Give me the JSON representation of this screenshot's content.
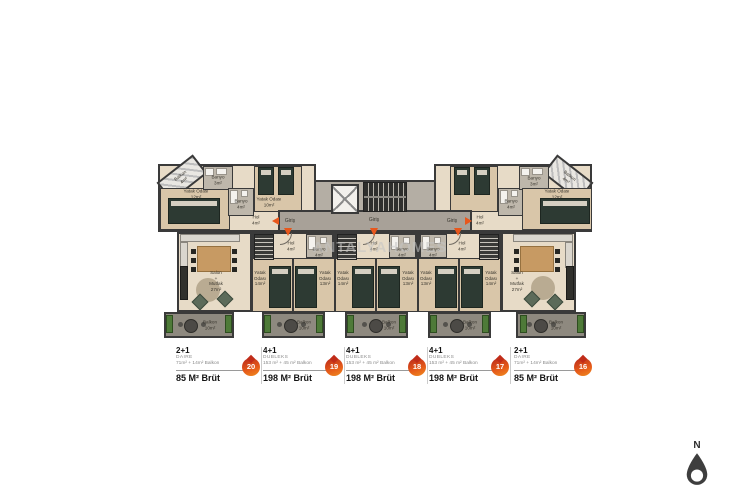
{
  "units": [
    {
      "type": "2+1",
      "subtype": "DAIRE",
      "detail": "71m² + 14m² Balkon",
      "brut": "85 M² Brüt",
      "badge": "20"
    },
    {
      "type": "4+1",
      "subtype": "DUBLEKS",
      "detail": "153 m² + 45 m² Balkon",
      "brut": "198 M² Brüt",
      "badge": "19"
    },
    {
      "type": "4+1",
      "subtype": "DUBLEKS",
      "detail": "153 m² + 45 m² Balkon",
      "brut": "198 M² Brüt",
      "badge": "18"
    },
    {
      "type": "4+1",
      "subtype": "DUBLEKS",
      "detail": "153 m² + 45 m² Balkon",
      "brut": "198 M² Brüt",
      "badge": "17"
    },
    {
      "type": "2+1",
      "subtype": "DAIRE",
      "detail": "71m² + 14m² Balkon",
      "brut": "85 M² Brüt",
      "badge": "16"
    }
  ],
  "watermark": "ANTALYAHOMES",
  "compass": {
    "label": "N"
  },
  "colors": {
    "accent": "#e8571c",
    "badge_dark": "#b9271b",
    "badge_light": "#ef8c1e",
    "wall": "#3a3a3a",
    "floor": "#e7dbc7",
    "corridor": "#a8a198",
    "balcony_green": "#4e7a38"
  },
  "plan": {
    "labels": [
      {
        "t": "Balkon\n4m²",
        "x": 182,
        "y": 178,
        "r": -38
      },
      {
        "t": "Banyo\n3m²",
        "x": 218,
        "y": 180
      },
      {
        "t": "Yatak Odası\n12m²",
        "x": 196,
        "y": 194
      },
      {
        "t": "Banyo\n4m²",
        "x": 241,
        "y": 204
      },
      {
        "t": "Yatak Odası\n10m²",
        "x": 269,
        "y": 202
      },
      {
        "t": "Hol\n4m²",
        "x": 256,
        "y": 220
      },
      {
        "t": "Giriş",
        "x": 290,
        "y": 221,
        "s": 5
      },
      {
        "t": "Giriş",
        "x": 374,
        "y": 220,
        "s": 5
      },
      {
        "t": "Giriş",
        "x": 452,
        "y": 221,
        "s": 5
      },
      {
        "t": "Hol\n4m²",
        "x": 480,
        "y": 220
      },
      {
        "t": "Banyo\n4m²",
        "x": 511,
        "y": 204
      },
      {
        "t": "Banyo\n3m²",
        "x": 534,
        "y": 181
      },
      {
        "t": "Yatak Odası\n12m²",
        "x": 557,
        "y": 194
      },
      {
        "t": "Balkon\n4m²",
        "x": 568,
        "y": 178,
        "r": 38
      },
      {
        "t": "Salon\n+\nMutfak\n27m²",
        "x": 216,
        "y": 281
      },
      {
        "t": "Salon\n+\nMutfak\n27m²",
        "x": 517,
        "y": 281
      },
      {
        "t": "Hol\n4m²",
        "x": 291,
        "y": 246
      },
      {
        "t": "Banyo\n4m²",
        "x": 319,
        "y": 252
      },
      {
        "t": "Yatak\nOdası\n14m²",
        "x": 260,
        "y": 278
      },
      {
        "t": "Yatak\nOdası\n13m²",
        "x": 325,
        "y": 278
      },
      {
        "t": "Hol\n4m²",
        "x": 374,
        "y": 246
      },
      {
        "t": "Banyo\n4m²",
        "x": 402,
        "y": 252
      },
      {
        "t": "Yatak\nOdası\n14m²",
        "x": 343,
        "y": 278
      },
      {
        "t": "Yatak\nOdası\n13m²",
        "x": 408,
        "y": 278
      },
      {
        "t": "Banyo\n4m²",
        "x": 433,
        "y": 252
      },
      {
        "t": "Hol\n4m²",
        "x": 462,
        "y": 246
      },
      {
        "t": "Yatak\nOdası\n13m²",
        "x": 426,
        "y": 278
      },
      {
        "t": "Yatak\nOdası\n14m²",
        "x": 491,
        "y": 278
      },
      {
        "t": "Balkon\n10m²",
        "x": 210,
        "y": 325
      },
      {
        "t": "Balkon\n10m²",
        "x": 304,
        "y": 325
      },
      {
        "t": "Balkon\n10m²",
        "x": 389,
        "y": 325
      },
      {
        "t": "Balkon\n10m²",
        "x": 470,
        "y": 325
      },
      {
        "t": "Balkon\n10m²",
        "x": 556,
        "y": 325
      }
    ],
    "arrows": [
      {
        "x": 272,
        "y": 217,
        "dir": "left"
      },
      {
        "x": 284,
        "y": 228,
        "dir": "down"
      },
      {
        "x": 370,
        "y": 228,
        "dir": "down"
      },
      {
        "x": 454,
        "y": 228,
        "dir": "down"
      },
      {
        "x": 465,
        "y": 217,
        "dir": "right"
      }
    ],
    "decor": [
      {
        "k": "bed",
        "x": 168,
        "y": 198,
        "w": 52,
        "h": 26
      },
      {
        "k": "bed",
        "x": 258,
        "y": 167,
        "w": 16,
        "h": 28
      },
      {
        "k": "bed",
        "x": 278,
        "y": 167,
        "w": 16,
        "h": 28
      },
      {
        "k": "bed",
        "x": 454,
        "y": 167,
        "w": 16,
        "h": 28
      },
      {
        "k": "bed",
        "x": 474,
        "y": 167,
        "w": 16,
        "h": 28
      },
      {
        "k": "bed",
        "x": 540,
        "y": 198,
        "w": 50,
        "h": 26
      },
      {
        "k": "bed",
        "x": 269,
        "y": 266,
        "w": 22,
        "h": 42
      },
      {
        "k": "bed",
        "x": 295,
        "y": 266,
        "w": 22,
        "h": 42
      },
      {
        "k": "bed",
        "x": 352,
        "y": 266,
        "w": 22,
        "h": 42
      },
      {
        "k": "bed",
        "x": 378,
        "y": 266,
        "w": 22,
        "h": 42
      },
      {
        "k": "bed",
        "x": 435,
        "y": 266,
        "w": 22,
        "h": 42
      },
      {
        "k": "bed",
        "x": 461,
        "y": 266,
        "w": 22,
        "h": 42
      },
      {
        "k": "counter",
        "x": 180,
        "y": 234,
        "w": 60,
        "h": 8
      },
      {
        "k": "counter",
        "x": 180,
        "y": 242,
        "w": 8,
        "h": 26
      },
      {
        "k": "counter",
        "x": 513,
        "y": 234,
        "w": 60,
        "h": 8
      },
      {
        "k": "counter",
        "x": 565,
        "y": 242,
        "w": 8,
        "h": 26
      },
      {
        "k": "dtable",
        "x": 197,
        "y": 246,
        "w": 34,
        "h": 26
      },
      {
        "k": "dtable",
        "x": 520,
        "y": 246,
        "w": 34,
        "h": 26
      },
      {
        "k": "chair",
        "x": 191,
        "y": 249,
        "w": 5,
        "h": 5
      },
      {
        "k": "chair",
        "x": 191,
        "y": 258,
        "w": 5,
        "h": 5
      },
      {
        "k": "chair",
        "x": 191,
        "y": 267,
        "w": 5,
        "h": 5
      },
      {
        "k": "chair",
        "x": 232,
        "y": 249,
        "w": 5,
        "h": 5
      },
      {
        "k": "chair",
        "x": 232,
        "y": 258,
        "w": 5,
        "h": 5
      },
      {
        "k": "chair",
        "x": 232,
        "y": 267,
        "w": 5,
        "h": 5
      },
      {
        "k": "chair",
        "x": 514,
        "y": 249,
        "w": 5,
        "h": 5
      },
      {
        "k": "chair",
        "x": 514,
        "y": 258,
        "w": 5,
        "h": 5
      },
      {
        "k": "chair",
        "x": 514,
        "y": 267,
        "w": 5,
        "h": 5
      },
      {
        "k": "chair",
        "x": 555,
        "y": 249,
        "w": 5,
        "h": 5
      },
      {
        "k": "chair",
        "x": 555,
        "y": 258,
        "w": 5,
        "h": 5
      },
      {
        "k": "chair",
        "x": 555,
        "y": 267,
        "w": 5,
        "h": 5
      },
      {
        "k": "rug",
        "x": 196,
        "y": 278,
        "w": 24,
        "h": 24
      },
      {
        "k": "rug",
        "x": 531,
        "y": 276,
        "w": 24,
        "h": 24
      },
      {
        "k": "sofa",
        "x": 180,
        "y": 266,
        "w": 8,
        "h": 34
      },
      {
        "k": "sofa",
        "x": 566,
        "y": 266,
        "w": 8,
        "h": 34
      },
      {
        "k": "arm",
        "x": 194,
        "y": 296,
        "w": 12,
        "h": 12,
        "r": 45
      },
      {
        "k": "arm",
        "x": 219,
        "y": 293,
        "w": 12,
        "h": 12,
        "r": 45
      },
      {
        "k": "arm",
        "x": 526,
        "y": 293,
        "w": 12,
        "h": 12,
        "r": 45
      },
      {
        "k": "arm",
        "x": 549,
        "y": 296,
        "w": 12,
        "h": 12,
        "r": 45
      },
      {
        "k": "planter",
        "x": 166,
        "y": 315,
        "w": 7,
        "h": 18
      },
      {
        "k": "planter",
        "x": 225,
        "y": 315,
        "w": 7,
        "h": 18
      },
      {
        "k": "planter",
        "x": 264,
        "y": 315,
        "w": 7,
        "h": 18
      },
      {
        "k": "planter",
        "x": 316,
        "y": 315,
        "w": 7,
        "h": 18
      },
      {
        "k": "planter",
        "x": 347,
        "y": 315,
        "w": 7,
        "h": 18
      },
      {
        "k": "planter",
        "x": 399,
        "y": 315,
        "w": 7,
        "h": 18
      },
      {
        "k": "planter",
        "x": 430,
        "y": 315,
        "w": 7,
        "h": 18
      },
      {
        "k": "planter",
        "x": 482,
        "y": 315,
        "w": 7,
        "h": 18
      },
      {
        "k": "planter",
        "x": 520,
        "y": 315,
        "w": 7,
        "h": 18
      },
      {
        "k": "planter",
        "x": 577,
        "y": 315,
        "w": 7,
        "h": 18
      },
      {
        "k": "btable",
        "x": 184,
        "y": 319,
        "w": 14,
        "h": 14
      },
      {
        "k": "btable",
        "x": 284,
        "y": 319,
        "w": 14,
        "h": 14
      },
      {
        "k": "btable",
        "x": 369,
        "y": 319,
        "w": 14,
        "h": 14
      },
      {
        "k": "btable",
        "x": 450,
        "y": 319,
        "w": 14,
        "h": 14
      },
      {
        "k": "btable",
        "x": 534,
        "y": 319,
        "w": 14,
        "h": 14
      },
      {
        "k": "dot",
        "x": 178,
        "y": 322,
        "w": 5,
        "h": 5
      },
      {
        "k": "dot",
        "x": 201,
        "y": 322,
        "w": 5,
        "h": 5
      },
      {
        "k": "dot",
        "x": 277,
        "y": 322,
        "w": 5,
        "h": 5
      },
      {
        "k": "dot",
        "x": 301,
        "y": 322,
        "w": 5,
        "h": 5
      },
      {
        "k": "dot",
        "x": 362,
        "y": 322,
        "w": 5,
        "h": 5
      },
      {
        "k": "dot",
        "x": 386,
        "y": 322,
        "w": 5,
        "h": 5
      },
      {
        "k": "dot",
        "x": 443,
        "y": 322,
        "w": 5,
        "h": 5
      },
      {
        "k": "dot",
        "x": 467,
        "y": 322,
        "w": 5,
        "h": 5
      },
      {
        "k": "dot",
        "x": 527,
        "y": 322,
        "w": 5,
        "h": 5
      },
      {
        "k": "dot",
        "x": 551,
        "y": 322,
        "w": 5,
        "h": 5
      },
      {
        "k": "fix",
        "x": 205,
        "y": 168,
        "w": 9,
        "h": 8
      },
      {
        "k": "fix",
        "x": 216,
        "y": 168,
        "w": 11,
        "h": 7
      },
      {
        "k": "fix",
        "x": 230,
        "y": 190,
        "w": 8,
        "h": 14
      },
      {
        "k": "fix",
        "x": 241,
        "y": 190,
        "w": 7,
        "h": 7
      },
      {
        "k": "fix",
        "x": 521,
        "y": 168,
        "w": 9,
        "h": 8
      },
      {
        "k": "fix",
        "x": 532,
        "y": 168,
        "w": 11,
        "h": 7
      },
      {
        "k": "fix",
        "x": 500,
        "y": 190,
        "w": 8,
        "h": 14
      },
      {
        "k": "fix",
        "x": 511,
        "y": 190,
        "w": 7,
        "h": 7
      },
      {
        "k": "fix",
        "x": 308,
        "y": 236,
        "w": 8,
        "h": 14
      },
      {
        "k": "fix",
        "x": 320,
        "y": 237,
        "w": 7,
        "h": 7
      },
      {
        "k": "fix",
        "x": 391,
        "y": 236,
        "w": 8,
        "h": 14
      },
      {
        "k": "fix",
        "x": 403,
        "y": 237,
        "w": 7,
        "h": 7
      },
      {
        "k": "fix",
        "x": 422,
        "y": 236,
        "w": 8,
        "h": 14
      },
      {
        "k": "fix",
        "x": 434,
        "y": 237,
        "w": 7,
        "h": 7
      },
      {
        "k": "stairsv",
        "x": 254,
        "y": 234,
        "w": 20,
        "h": 26
      },
      {
        "k": "stairsv",
        "x": 337,
        "y": 234,
        "w": 20,
        "h": 26
      },
      {
        "k": "stairsv",
        "x": 479,
        "y": 234,
        "w": 20,
        "h": 26
      },
      {
        "k": "stairsh",
        "x": 363,
        "y": 182,
        "w": 44,
        "h": 30
      },
      {
        "k": "elev",
        "x": 331,
        "y": 184,
        "w": 28,
        "h": 30
      },
      {
        "k": "arc",
        "x": 280,
        "y": 233,
        "w": 12,
        "h": 12
      },
      {
        "k": "arc",
        "x": 363,
        "y": 233,
        "w": 12,
        "h": 12
      },
      {
        "k": "arc",
        "x": 449,
        "y": 233,
        "w": 12,
        "h": 12
      }
    ]
  }
}
